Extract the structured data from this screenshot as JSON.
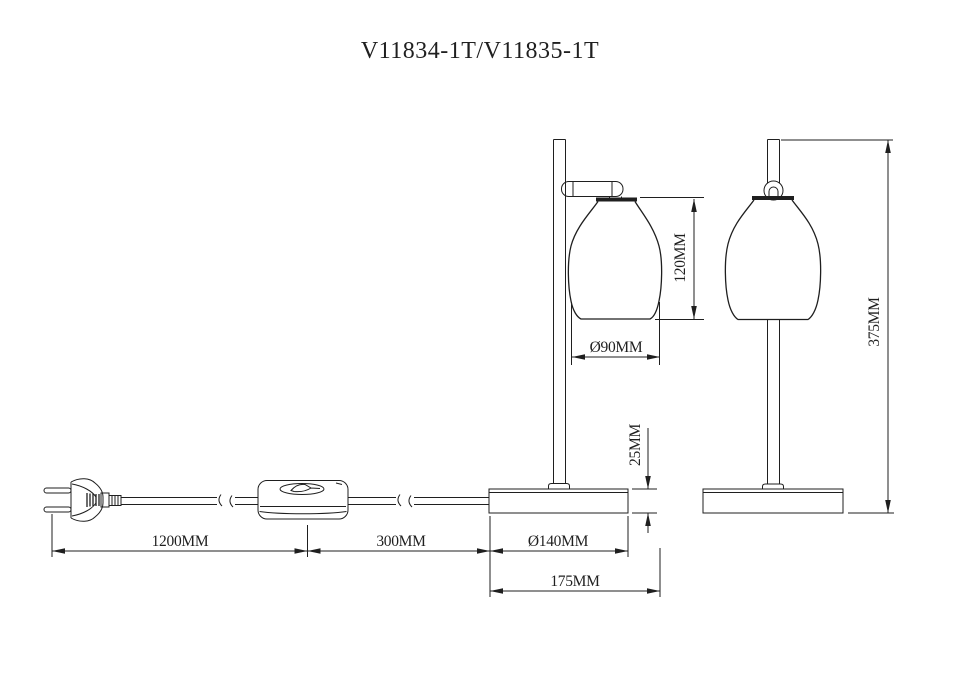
{
  "title": "V11834-1T/V11835-1T",
  "units": "MM",
  "colors": {
    "line": "#1f1f1f",
    "background": "#ffffff"
  },
  "dimensions": {
    "cord_plug_to_switch": {
      "label": "1200MM",
      "value": 1200
    },
    "cord_switch_to_base": {
      "label": "300MM",
      "value": 300
    },
    "base_diameter": {
      "label": "Ø140MM",
      "value": 140
    },
    "overall_depth": {
      "label": "175MM",
      "value": 175
    },
    "base_height": {
      "label": "25MM",
      "value": 25
    },
    "shade_height": {
      "label": "120MM",
      "value": 120
    },
    "shade_diameter": {
      "label": "Ø90MM",
      "value": 90
    },
    "overall_height": {
      "label": "375MM",
      "value": 375
    }
  }
}
